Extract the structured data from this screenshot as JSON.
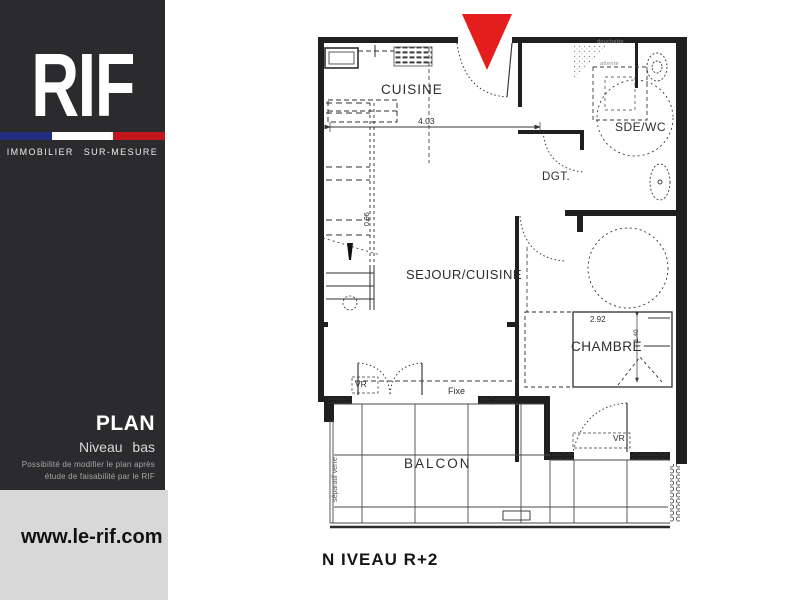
{
  "sidebar": {
    "logo": "RIF",
    "tagline": "IMMOBILIER SUR-MESURE",
    "flag": {
      "blue": "#232d7e",
      "white": "#ffffff",
      "red": "#c3161c"
    },
    "plan_label": "PLAN",
    "plan_sublabel": "Niveau bas",
    "note": "Possibilité de modifier le plan après étude de faisabilité par le RIF",
    "website": "www.le-rif.com"
  },
  "plan": {
    "caption": "N IVEAU R+2",
    "marker_color": "#e41d1d",
    "rooms": {
      "cuisine": "CUISINE",
      "sde_wc": "SDE/WC",
      "dgt": "DGT.",
      "sejour": "SEJOUR/CUISINE",
      "chambre": "CHAMBRE",
      "balcon": "BALCON"
    },
    "dimensions": {
      "cuisine_width": "4.03",
      "chambre_width": "2.92",
      "stair_width": "0.96",
      "bed_width": "1.40"
    },
    "annotations": {
      "vr_sejour": "VR",
      "vr_chambre": "VR",
      "fixe": "Fixe",
      "separatif": "séparatif verre",
      "douchette": "douchette",
      "attente": "attente"
    }
  }
}
